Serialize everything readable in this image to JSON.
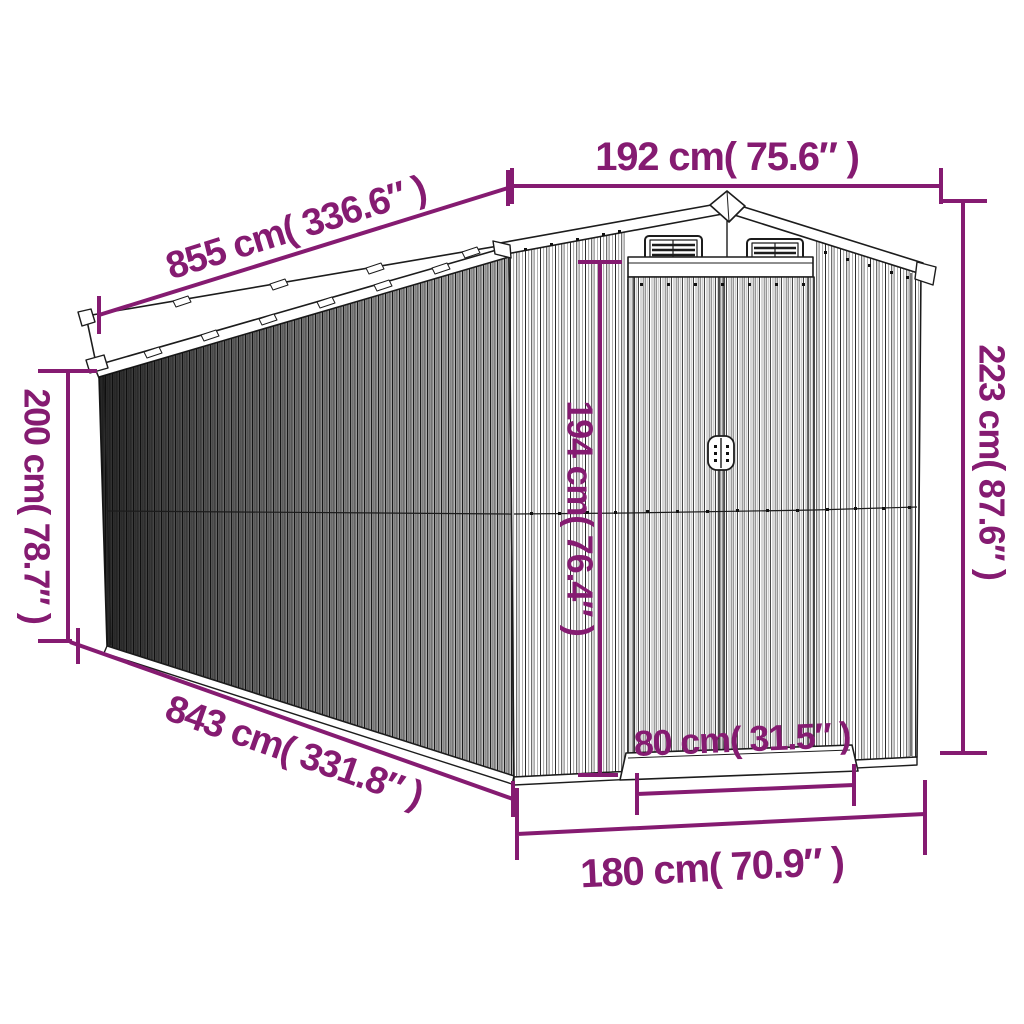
{
  "diagram": {
    "title": "garden-shed-dimension-diagram",
    "accent_color": "#851B71",
    "line_color": "#1c1c1c"
  },
  "dimensions": {
    "roof_length": "855 cm( 336.6″ )",
    "front_width": "192 cm( 75.6″ )",
    "back_height": "200 cm( 78.7″ )",
    "total_height": "223 cm( 87.6″ )",
    "door_height": "194 cm( 76.4″ )",
    "base_length": "843 cm( 331.8″ )",
    "door_width": "80 cm( 31.5″ )",
    "base_width": "180 cm( 70.9″ )"
  }
}
